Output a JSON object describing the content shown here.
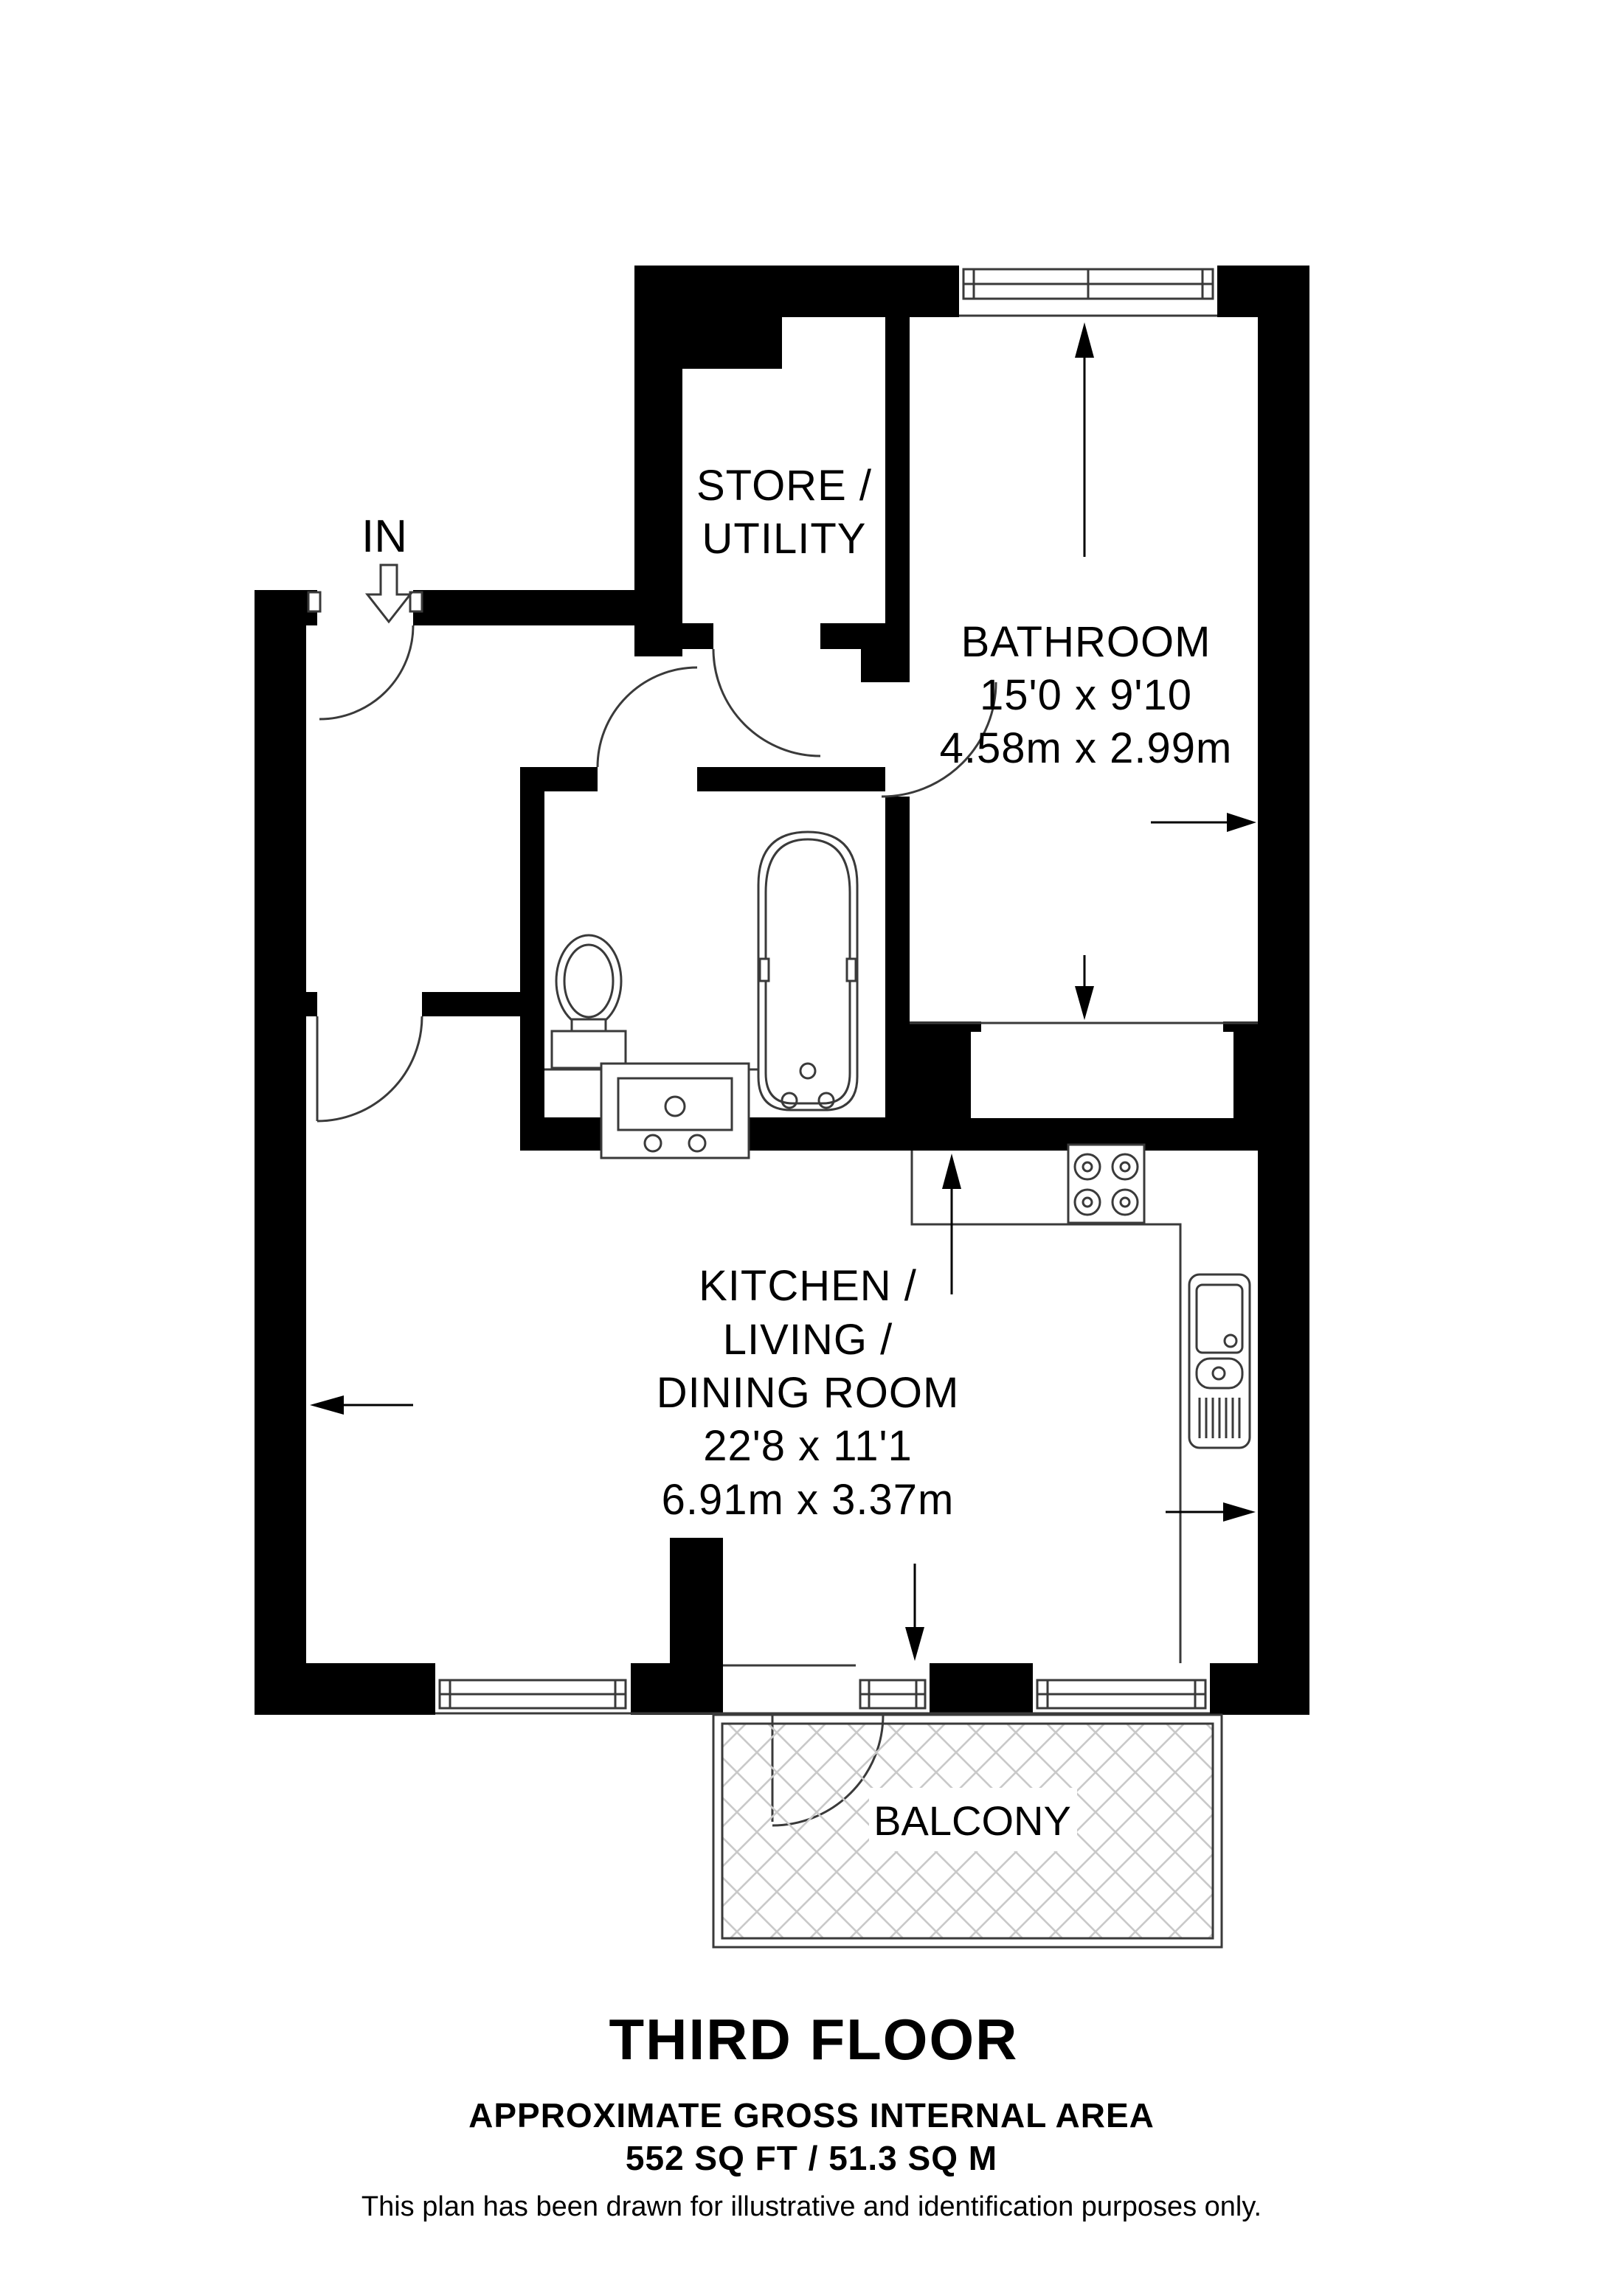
{
  "plan": {
    "entrance_label": "IN",
    "rooms": {
      "store": {
        "line1": "STORE /",
        "line2": "UTILITY"
      },
      "bathroom": {
        "name": "BATHROOM",
        "imperial": "15'0 x 9'10",
        "metric": "4.58m x 2.99m"
      },
      "kitchen": {
        "line1": "KITCHEN /",
        "line2": "LIVING /",
        "line3": "DINING ROOM",
        "imperial": "22'8 x 11'1",
        "metric": "6.91m x 3.37m"
      },
      "balcony": {
        "name": "BALCONY"
      }
    },
    "footer": {
      "floor_label": "THIRD FLOOR",
      "area_heading": "APPROXIMATE GROSS INTERNAL AREA",
      "area_value": "552 SQ FT / 51.3 SQ M",
      "disclaimer": "This plan has been drawn for illustrative and identification purposes only."
    },
    "colors": {
      "wall": "#000000",
      "line": "#3a3a3a",
      "hatch": "#c9c9c9",
      "background": "#ffffff"
    }
  }
}
